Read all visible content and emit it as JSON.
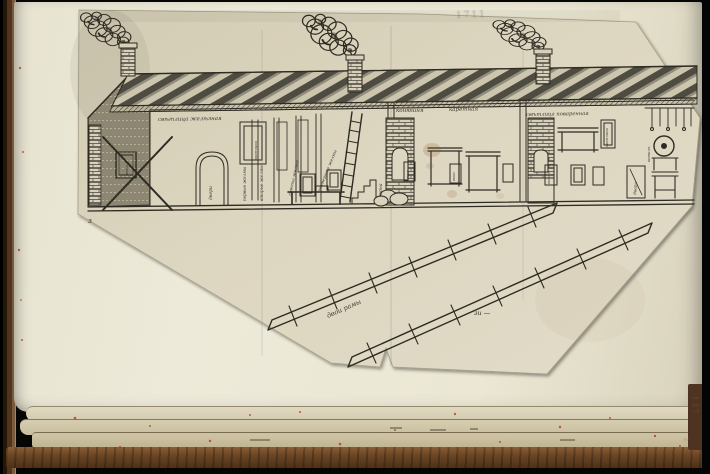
{
  "colors": {
    "ink": "#2e2b23",
    "paper-page": "#ebe7d4",
    "paper-sheet": "#dcd5bf",
    "leather": "#6a4526",
    "background": "#060605",
    "speckle-red": "#b23a2a"
  },
  "labels": [
    {
      "id": "room1-title",
      "text": "свѣтлица желѣзная",
      "x": 158,
      "y": 121,
      "rot": -1,
      "size": 5.5
    },
    {
      "id": "room2-title-a",
      "text": "конюшня",
      "x": 396,
      "y": 112,
      "rot": 0,
      "size": 5.5
    },
    {
      "id": "room2-title-b",
      "text": "каретная",
      "x": 449,
      "y": 111,
      "rot": -1,
      "size": 5.5
    },
    {
      "id": "room3-title",
      "text": "свѣтлица поваренная",
      "x": 526,
      "y": 116,
      "rot": -1,
      "size": 5.2
    },
    {
      "id": "post-label-1",
      "text": "первые желмы",
      "x": 246,
      "y": 201,
      "rot": -90,
      "size": 4.2
    },
    {
      "id": "post-label-2",
      "text": "вторые желмы",
      "x": 263,
      "y": 201,
      "rot": -90,
      "size": 4.2
    },
    {
      "id": "post-label-3",
      "text": "третьи желмы",
      "x": 291,
      "y": 196,
      "rot": -78,
      "size": 4.2
    },
    {
      "id": "post-label-4",
      "text": "четвертые желмы",
      "x": 320,
      "y": 192,
      "rot": -68,
      "size": 4.2
    },
    {
      "id": "window-label-top-left",
      "text": "окончина",
      "x": 257,
      "y": 160,
      "rot": -90,
      "size": 3.8
    },
    {
      "id": "door-label-left",
      "text": "двери",
      "x": 212,
      "y": 200,
      "rot": -90,
      "size": 4.5
    },
    {
      "id": "cross-window-label",
      "text": "окно",
      "x": 128,
      "y": 175,
      "rot": -90,
      "size": 4
    },
    {
      "id": "furnace-label",
      "text": "горна",
      "x": 382,
      "y": 197,
      "rot": -90,
      "size": 4.5
    },
    {
      "id": "mid-window-label-1",
      "text": "окно",
      "x": 409,
      "y": 179,
      "rot": -90,
      "size": 3.5
    },
    {
      "id": "mid-window-label-2",
      "text": "окно",
      "x": 455,
      "y": 181,
      "rot": -90,
      "size": 3.5
    },
    {
      "id": "right-window-label",
      "text": "окончина",
      "x": 608,
      "y": 147,
      "rot": -90,
      "size": 3.8
    },
    {
      "id": "right-small-window-label",
      "text": "окно",
      "x": 550,
      "y": 184,
      "rot": -90,
      "size": 3.5
    },
    {
      "id": "right-door-label",
      "text": "двери",
      "x": 636,
      "y": 195,
      "rot": -85,
      "size": 4.2
    },
    {
      "id": "cauldron-label",
      "text": "котелъ",
      "x": 650,
      "y": 162,
      "rot": -90,
      "size": 3.8
    },
    {
      "id": "frames-caption",
      "text": "двои рамы",
      "x": 328,
      "y": 318,
      "rot": -24,
      "size": 6.5
    },
    {
      "id": "measure-mark",
      "text": "зи —",
      "x": 474,
      "y": 315,
      "rot": 0,
      "size": 6.5
    },
    {
      "id": "corner-mark",
      "text": "з",
      "x": 88,
      "y": 223,
      "rot": 0,
      "size": 7
    },
    {
      "id": "folio-number",
      "text": "137",
      "x": 693,
      "y": 396,
      "rot": 90,
      "size": 7,
      "cls": "pencil"
    },
    {
      "id": "pencil-inscription",
      "text": "1711",
      "x": 456,
      "y": 18,
      "rot": -2,
      "size": 9,
      "cls": "pencil"
    },
    {
      "id": "pencil-smudge",
      "text": "2",
      "x": 684,
      "y": 438,
      "rot": 80,
      "size": 6,
      "cls": "pencil"
    }
  ]
}
